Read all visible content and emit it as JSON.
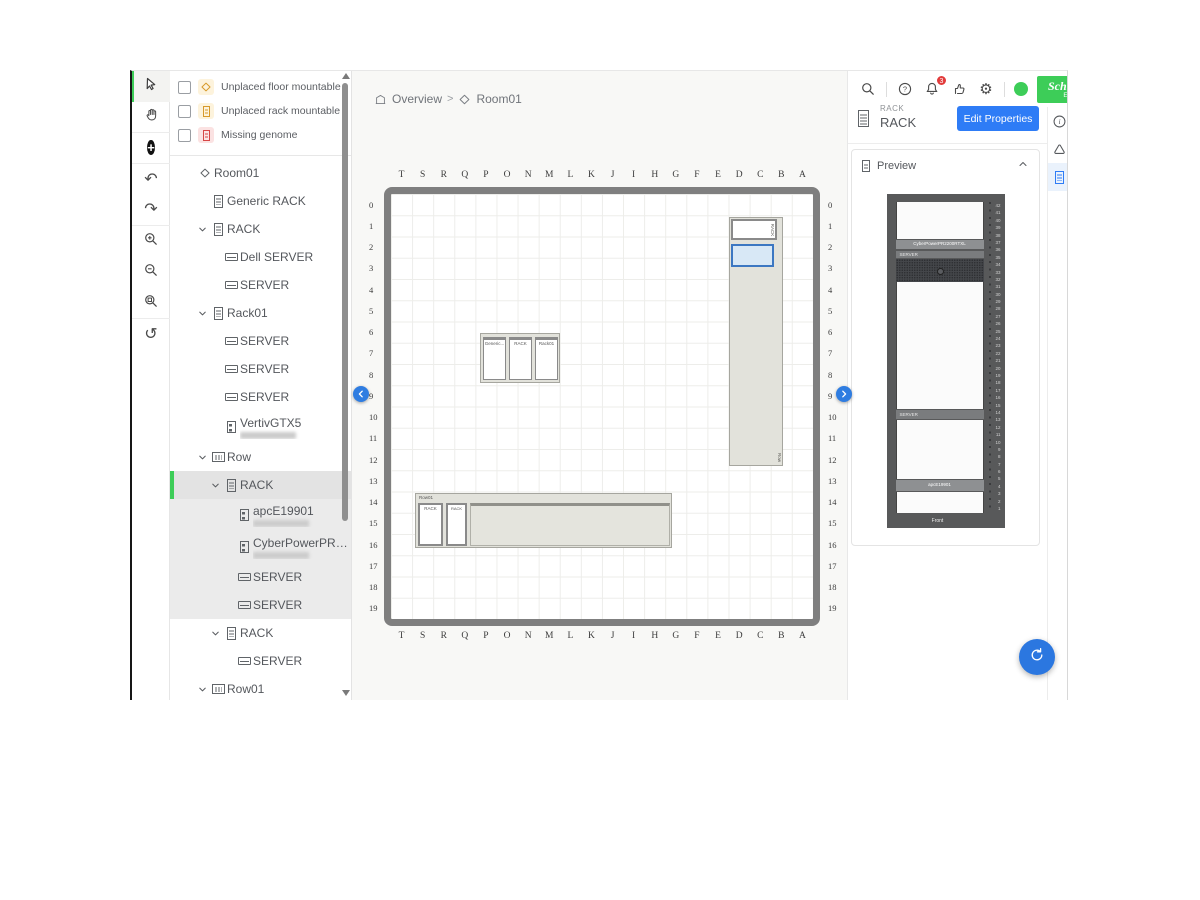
{
  "brand": {
    "name_line1": "Schneider",
    "name_line2": "Electric",
    "green": "#3dcd58"
  },
  "topbar": {
    "notification_count": "3"
  },
  "toolbar": {
    "tools": [
      {
        "name": "select-tool",
        "icon": "cursor",
        "active": true
      },
      {
        "name": "pan-tool",
        "icon": "hand",
        "group_end": true
      },
      {
        "name": "add-device-button",
        "icon": "plus-circle",
        "group_end": true
      },
      {
        "name": "undo-button",
        "icon": "undo"
      },
      {
        "name": "redo-button",
        "icon": "redo",
        "group_end": true
      },
      {
        "name": "zoom-in-button",
        "icon": "zoom-in"
      },
      {
        "name": "zoom-out-button",
        "icon": "zoom-out"
      },
      {
        "name": "zoom-fit-button",
        "icon": "zoom-fit",
        "group_end": true
      },
      {
        "name": "history-button",
        "icon": "history"
      }
    ]
  },
  "filters": [
    {
      "label": "Unplaced floor mountable devices",
      "icon": "floor-device-icon",
      "tint": "amber"
    },
    {
      "label": "Unplaced rack mountable devices",
      "icon": "rack-device-icon",
      "tint": "amber"
    },
    {
      "label": "Missing genome",
      "icon": "missing-genome-icon",
      "tint": "red"
    }
  ],
  "tree": {
    "items": [
      {
        "label": "Room01",
        "level": 0,
        "icon": "room",
        "chevron": false
      },
      {
        "label": "Generic RACK",
        "level": 1,
        "icon": "rack",
        "chevron": false
      },
      {
        "label": "RACK",
        "level": 1,
        "icon": "rack",
        "chevron": true
      },
      {
        "label": "Dell SERVER",
        "level": 2,
        "icon": "server",
        "chevron": false
      },
      {
        "label": "SERVER",
        "level": 2,
        "icon": "server",
        "chevron": false
      },
      {
        "label": "Rack01",
        "level": 1,
        "icon": "rack",
        "chevron": true
      },
      {
        "label": "SERVER",
        "level": 2,
        "icon": "server",
        "chevron": false
      },
      {
        "label": "SERVER",
        "level": 2,
        "icon": "server",
        "chevron": false
      },
      {
        "label": "SERVER",
        "level": 2,
        "icon": "server",
        "chevron": false
      },
      {
        "label": "VertivGTX5",
        "level": 2,
        "icon": "ups",
        "chevron": false,
        "redacted_subtitle": true
      },
      {
        "label": "Row",
        "level": 1,
        "icon": "row",
        "chevron": true
      },
      {
        "label": "RACK",
        "level": 2,
        "icon": "rack",
        "chevron": true,
        "selected": true,
        "in_selection": true
      },
      {
        "label": "apcE19901",
        "level": 3,
        "icon": "ups",
        "chevron": false,
        "redacted_subtitle": true,
        "in_selection": true
      },
      {
        "label": "CyberPowerPR2200R...",
        "level": 3,
        "icon": "ups",
        "chevron": false,
        "redacted_subtitle": true,
        "in_selection": true
      },
      {
        "label": "SERVER",
        "level": 3,
        "icon": "server",
        "chevron": false,
        "in_selection": true
      },
      {
        "label": "SERVER",
        "level": 3,
        "icon": "server",
        "chevron": false,
        "in_selection": true
      },
      {
        "label": "RACK",
        "level": 2,
        "icon": "rack",
        "chevron": true
      },
      {
        "label": "SERVER",
        "level": 3,
        "icon": "server",
        "chevron": false
      },
      {
        "label": "Row01",
        "level": 1,
        "icon": "row",
        "chevron": true
      }
    ]
  },
  "breadcrumb": {
    "items": [
      {
        "label": "Overview",
        "icon": "overview"
      },
      {
        "label": "Room01",
        "icon": "room"
      }
    ],
    "separator": ">"
  },
  "floor": {
    "columns": [
      "T",
      "S",
      "R",
      "Q",
      "P",
      "O",
      "N",
      "M",
      "L",
      "K",
      "J",
      "I",
      "H",
      "G",
      "F",
      "E",
      "D",
      "C",
      "B",
      "A"
    ],
    "rows": [
      "0",
      "1",
      "2",
      "3",
      "4",
      "5",
      "6",
      "7",
      "8",
      "9",
      "10",
      "11",
      "12",
      "13",
      "14",
      "15",
      "16",
      "17",
      "18",
      "19"
    ],
    "objects": {
      "top_rack_label": "RACK",
      "vertical_row_label": "Row",
      "cluster_rack_labels": [
        "Generic...",
        "RACK",
        "Rack01"
      ],
      "bottom_row_title": "Row01",
      "bottom_rack_labels": [
        "RACK",
        "RACK"
      ]
    }
  },
  "inspector": {
    "type_label": "RACK",
    "name": "RACK",
    "edit_button_label": "Edit Properties",
    "preview": {
      "title": "Preview",
      "devices": {
        "cyber": "CyberPowerPR2200RTXL",
        "server_top": "SERVER",
        "server_mid": "SERVER",
        "apc": "apcE19901"
      },
      "front_label": "Front",
      "u_top": 42,
      "u_bottom": 1
    }
  },
  "right_rail": {
    "items": [
      {
        "name": "info"
      },
      {
        "name": "alarm"
      },
      {
        "name": "rack",
        "selected": true
      }
    ]
  }
}
